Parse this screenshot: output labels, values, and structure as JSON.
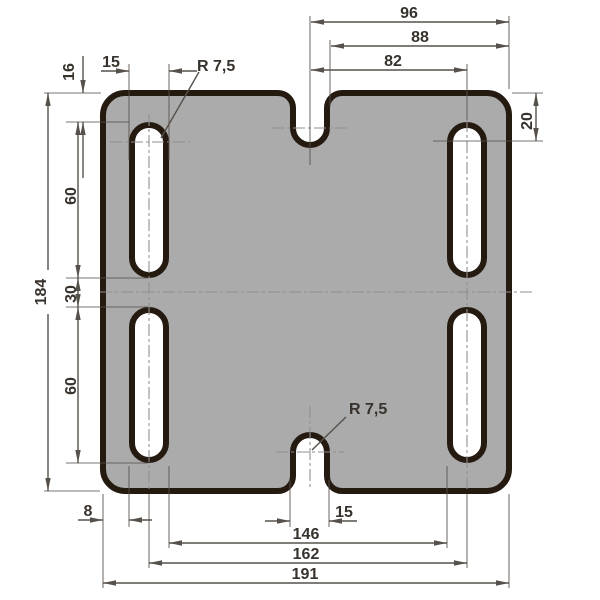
{
  "drawing": {
    "type": "technical-dimension-drawing",
    "part": "rectangular mounting plate with four slotted holes and two center notches",
    "units_style": "decimal comma (European)"
  },
  "colors": {
    "background": "#ffffff",
    "plate_fill": "#ababab",
    "hole_fill": "#ffffff",
    "outline": "#241a10",
    "dimension_line": "#56514b",
    "centerline": "#8f8f8f",
    "text_color": "#38322d"
  },
  "dims": {
    "overall_width": "191",
    "overall_height": "184",
    "bottom_to_slot_center_span": "162",
    "bottom_inner_slot_span": "146",
    "edge_to_slot": "8",
    "notch_width": "15",
    "notch_radius": "R 7,5",
    "top_notch_to_right_edge": "96",
    "top_88": "88",
    "top_notch_to_slot_center": "82",
    "right_edge_to_slot": "20",
    "left_edge_to_slot": "16",
    "slot_width": "15",
    "slot_radius": "R 7,5",
    "slot_length_top": "60",
    "slot_gap_middle": "30",
    "slot_length_bottom": "60"
  }
}
